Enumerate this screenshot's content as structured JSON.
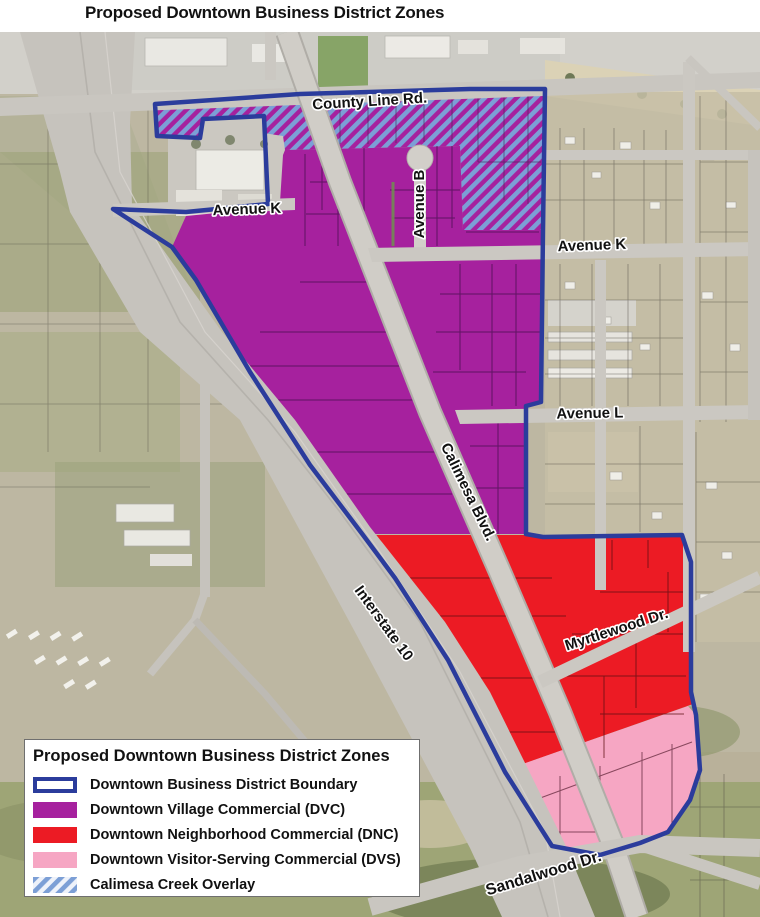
{
  "page_title": "Proposed Downtown Business District Zones",
  "map": {
    "street_labels": [
      {
        "id": "county-line-rd",
        "text": "County Line Rd."
      },
      {
        "id": "avenue-k-west",
        "text": "Avenue K"
      },
      {
        "id": "avenue-b",
        "text": "Avenue B"
      },
      {
        "id": "avenue-k-east",
        "text": "Avenue K"
      },
      {
        "id": "avenue-l",
        "text": "Avenue L"
      },
      {
        "id": "calimesa-blvd",
        "text": "Calimesa Blvd."
      },
      {
        "id": "interstate-10",
        "text": "Interstate 10"
      },
      {
        "id": "myrtlewood-dr",
        "text": "Myrtlewood Dr."
      },
      {
        "id": "sandalwood-dr",
        "text": "Sandalwood Dr."
      }
    ]
  },
  "legend": {
    "title": "Proposed Downtown Business District Zones",
    "items": [
      {
        "label": "Downtown Business District Boundary",
        "swatch": "boundary"
      },
      {
        "label": "Downtown Village Commercial (DVC)",
        "swatch": "dvc"
      },
      {
        "label": "Downtown Neighborhood Commercial (DNC)",
        "swatch": "dnc"
      },
      {
        "label": "Downtown Visitor-Serving Commercial (DVS)",
        "swatch": "dvs"
      },
      {
        "label": "Calimesa Creek Overlay",
        "swatch": "overlay"
      }
    ]
  },
  "colors": {
    "dvc": "#A6219E",
    "dnc": "#EC1B24",
    "dvs": "#F6A6C3",
    "boundary": "#2B3C9C",
    "overlay_stripe": "#7C9FD6"
  }
}
